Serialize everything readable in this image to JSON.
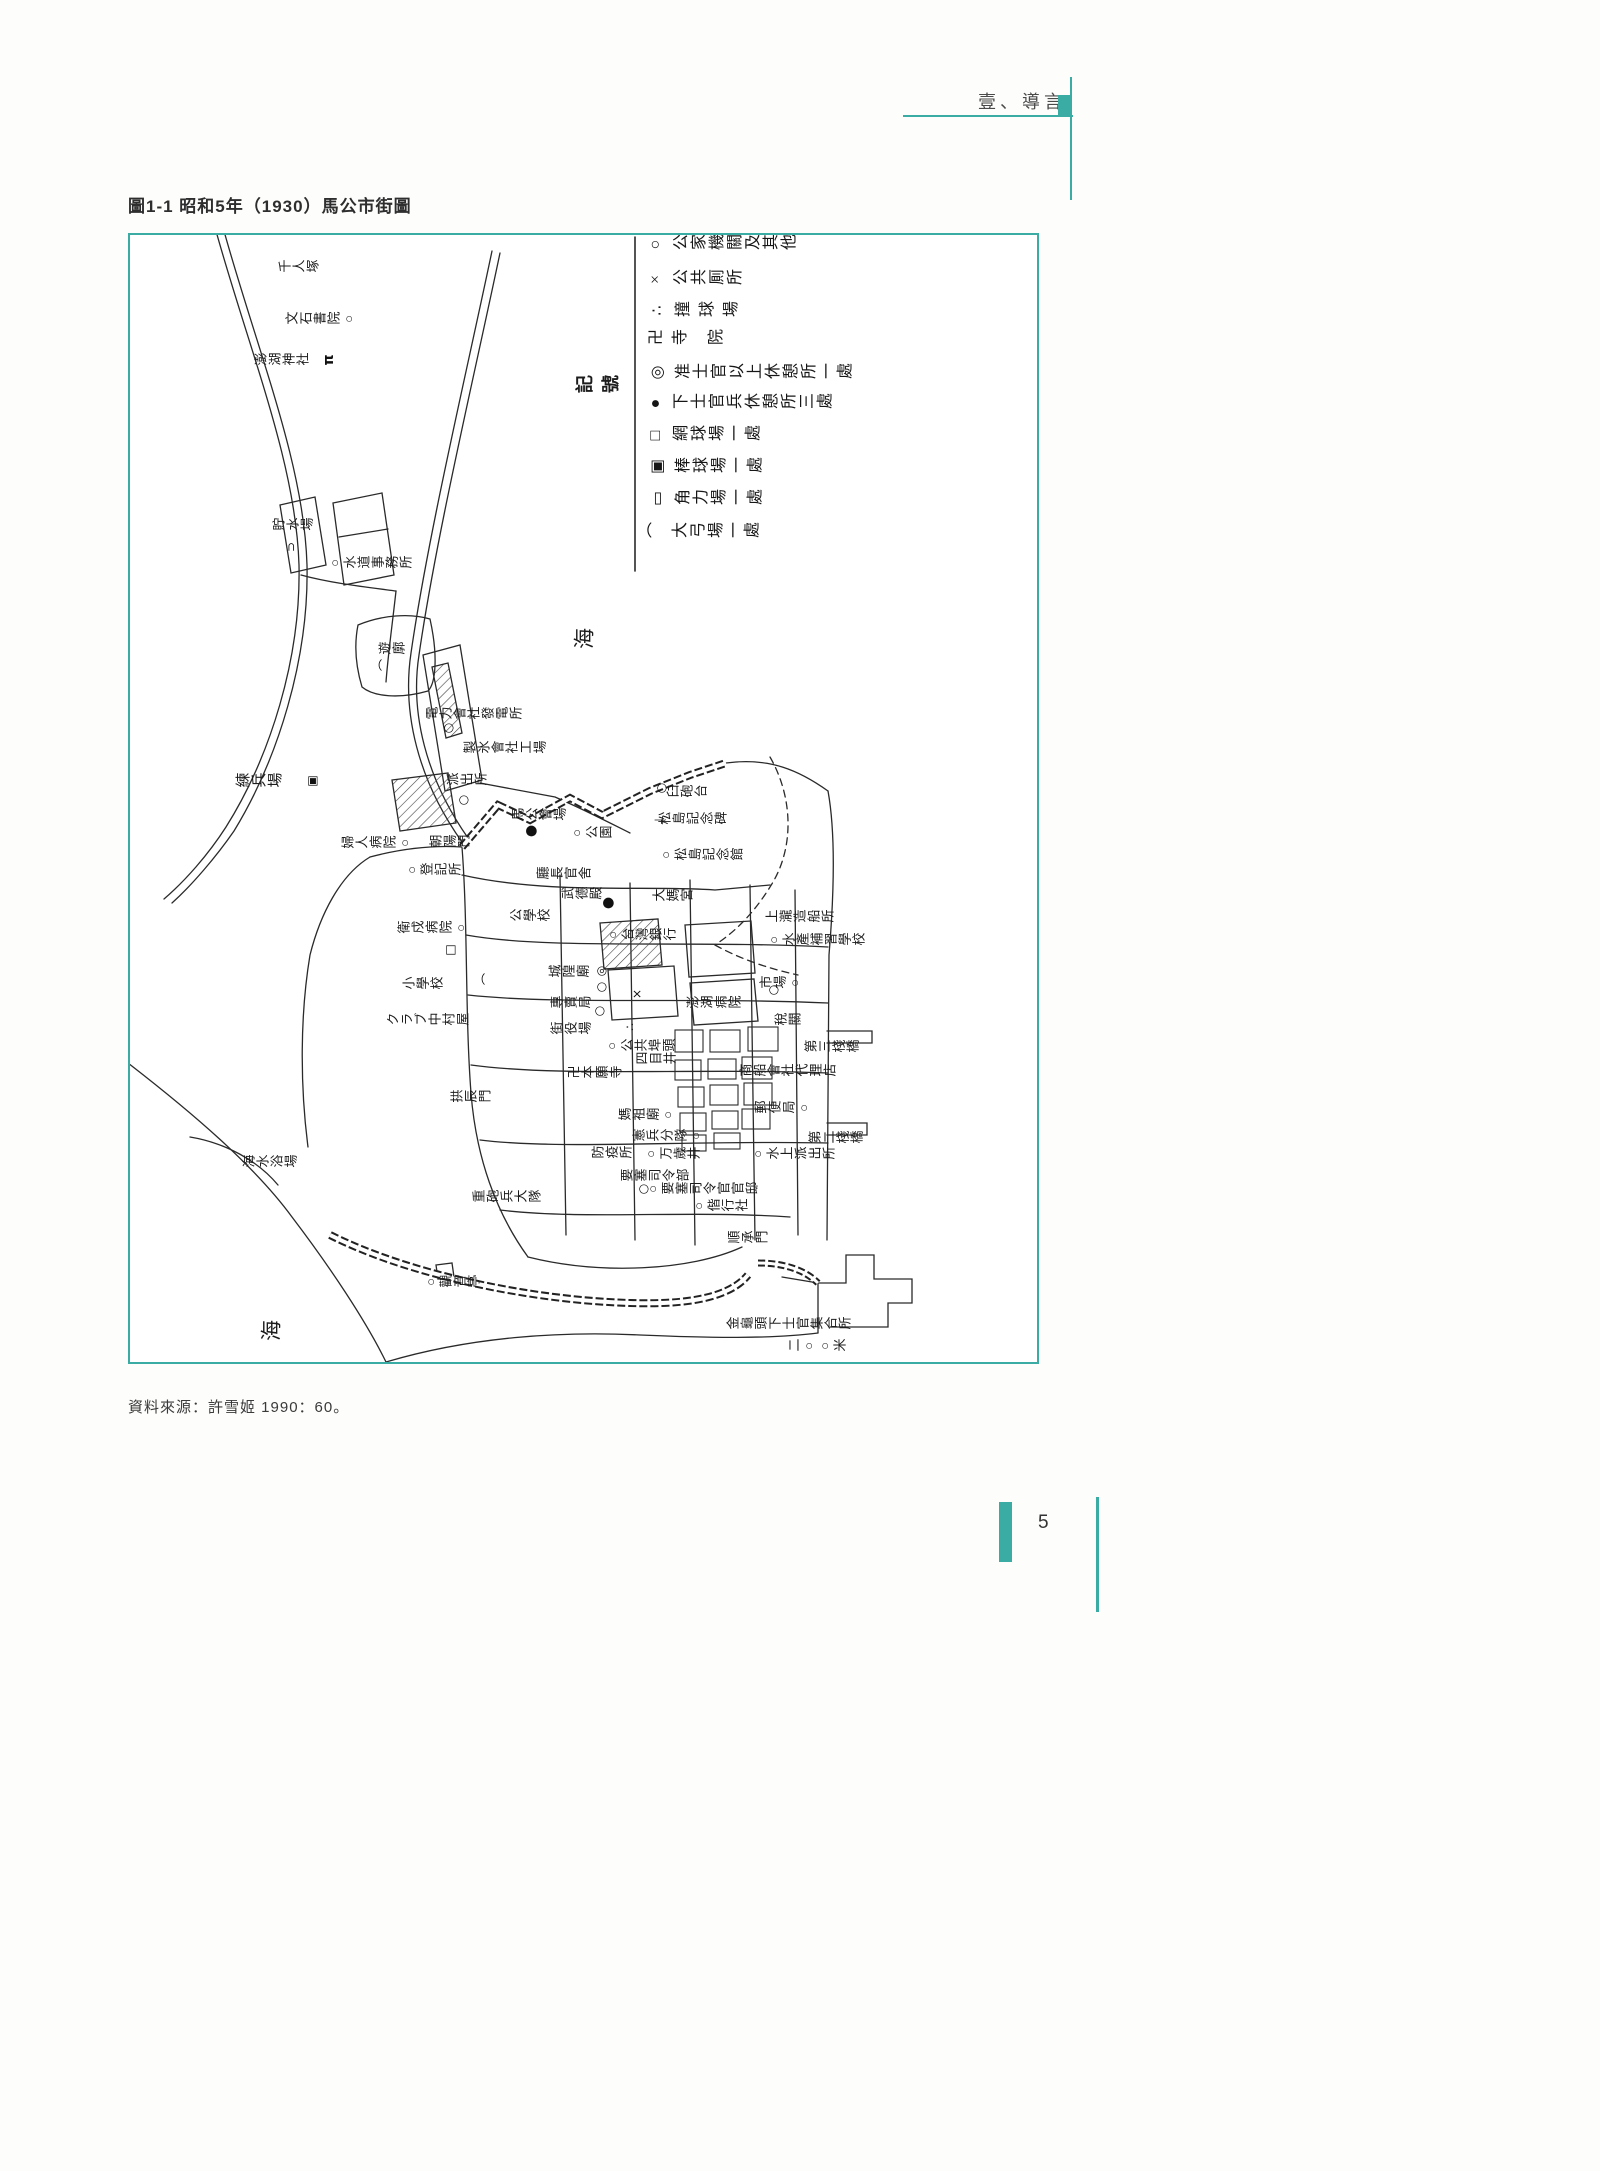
{
  "accent_color": "#3aaca4",
  "header": {
    "section_title": "壹、導言"
  },
  "figure": {
    "caption": "圖1-1  昭和5年（1930）馬公市街圖",
    "source": "資料來源：許雪姬 1990：60。"
  },
  "footer": {
    "page_number": "5"
  },
  "legend": {
    "title": "記號",
    "entries": [
      {
        "sym": "○",
        "text": "公家機關及其他"
      },
      {
        "sym": "×",
        "text": "公共厠所"
      },
      {
        "sym": "∴",
        "text": "撞 球 場"
      },
      {
        "sym": "卍",
        "text": "寺　院"
      },
      {
        "sym": "◎",
        "text": "准士官以上休憩所一處"
      },
      {
        "sym": "●",
        "text": "下士官兵休憩所三處"
      },
      {
        "sym": "□",
        "text": "網球場一處"
      },
      {
        "sym": "▣",
        "text": "棒球場一處"
      },
      {
        "sym": "▭",
        "text": "角力場一處"
      },
      {
        "sym": "⌒",
        "text": "大弓場一處"
      }
    ],
    "rows_y": [
      8,
      43,
      75,
      103,
      137,
      167,
      199,
      231,
      263,
      296
    ],
    "left_x": 517,
    "title_pos": {
      "x": 471,
      "y": 150
    }
  },
  "map": {
    "sea_label": "海",
    "labels": [
      {
        "t": "千人塚",
        "x": 169,
        "y": 32
      },
      {
        "t": "文石書院○",
        "x": 191,
        "y": 84
      },
      {
        "t": "澎湖神社",
        "x": 152,
        "y": 125
      },
      {
        "t": "貯水場",
        "x": 163,
        "y": 290
      },
      {
        "t": "○水道事務所",
        "x": 240,
        "y": 328
      },
      {
        "t": "遊廓",
        "x": 262,
        "y": 414
      },
      {
        "t": "海",
        "x": 455,
        "y": 405,
        "cls": "big"
      },
      {
        "t": "電力會社發電所",
        "x": 344,
        "y": 479
      },
      {
        "t": "製氷會社工場",
        "x": 375,
        "y": 513
      },
      {
        "t": "練兵場",
        "x": 129,
        "y": 547,
        "cls": "md"
      },
      {
        "t": "派出所",
        "x": 337,
        "y": 545
      },
      {
        "t": "馬公會場",
        "x": 409,
        "y": 580
      },
      {
        "t": "臼砲台",
        "x": 557,
        "y": 557
      },
      {
        "t": "松島記念碑",
        "x": 563,
        "y": 584
      },
      {
        "t": "○公園",
        "x": 461,
        "y": 598
      },
      {
        "t": "婦人病院○",
        "x": 247,
        "y": 608
      },
      {
        "t": "朝陽門",
        "x": 320,
        "y": 607
      },
      {
        "t": "○松島記念館",
        "x": 571,
        "y": 620
      },
      {
        "t": "○登記所",
        "x": 303,
        "y": 635
      },
      {
        "t": "廳長官舍",
        "x": 434,
        "y": 639
      },
      {
        "t": "武德殿",
        "x": 452,
        "y": 659
      },
      {
        "t": "大媽宮",
        "x": 543,
        "y": 661
      },
      {
        "t": "上瀧造船所",
        "x": 670,
        "y": 682
      },
      {
        "t": "公學校",
        "x": 400,
        "y": 681
      },
      {
        "t": "衛戍病院○",
        "x": 303,
        "y": 693
      },
      {
        "t": "○台灣銀行",
        "x": 511,
        "y": 700
      },
      {
        "t": "○水產補習學校",
        "x": 686,
        "y": 705
      },
      {
        "t": "城隍廟",
        "x": 439,
        "y": 737
      },
      {
        "t": "小學校",
        "x": 293,
        "y": 749
      },
      {
        "t": "市場○",
        "x": 651,
        "y": 748
      },
      {
        "t": "專賣局",
        "x": 441,
        "y": 768
      },
      {
        "t": "澎湖病院",
        "x": 584,
        "y": 768
      },
      {
        "t": "クラブ中村屋",
        "x": 298,
        "y": 785
      },
      {
        "t": "街役場",
        "x": 441,
        "y": 794
      },
      {
        "t": "稅關",
        "x": 658,
        "y": 785
      },
      {
        "t": "○公共埠頭",
        "x": 510,
        "y": 811
      },
      {
        "t": "四目井",
        "x": 526,
        "y": 824
      },
      {
        "t": "第三棧橋",
        "x": 702,
        "y": 812
      },
      {
        "t": "卍本願寺",
        "x": 465,
        "y": 838
      },
      {
        "t": "商船會社代理店",
        "x": 658,
        "y": 836
      },
      {
        "t": "拱辰門",
        "x": 341,
        "y": 862
      },
      {
        "t": "郵便局○",
        "x": 653,
        "y": 873
      },
      {
        "t": "媽祖廟○",
        "x": 517,
        "y": 880
      },
      {
        "t": "憲兵分隊○",
        "x": 538,
        "y": 901
      },
      {
        "t": "第二棧橋",
        "x": 706,
        "y": 903
      },
      {
        "t": "防疫所",
        "x": 482,
        "y": 918
      },
      {
        "t": "○万歲井",
        "x": 542,
        "y": 919
      },
      {
        "t": "○水上派出所",
        "x": 663,
        "y": 919
      },
      {
        "t": "海水浴場",
        "x": 140,
        "y": 927
      },
      {
        "t": "要塞司令部",
        "x": 525,
        "y": 941
      },
      {
        "t": "○要塞司令官官邸",
        "x": 572,
        "y": 954
      },
      {
        "t": "重砲兵大隊",
        "x": 377,
        "y": 962
      },
      {
        "t": "○偕行社",
        "x": 590,
        "y": 971
      },
      {
        "t": "順承門",
        "x": 618,
        "y": 1003
      },
      {
        "t": "○觀音亭",
        "x": 322,
        "y": 1047
      },
      {
        "t": "金龜頭下士官集合所",
        "x": 659,
        "y": 1089
      },
      {
        "t": "二○○米",
        "x": 687,
        "y": 1111
      },
      {
        "t": "海",
        "x": 142,
        "y": 1097,
        "cls": "big"
      }
    ],
    "marks": [
      {
        "k": "torii",
        "x": 199,
        "y": 125
      },
      {
        "k": "cup",
        "x": 161,
        "y": 312
      },
      {
        "k": "arc",
        "x": 255,
        "y": 430
      },
      {
        "k": "circle",
        "x": 318,
        "y": 493
      },
      {
        "k": "sqdot",
        "x": 182,
        "y": 546
      },
      {
        "k": "circle",
        "x": 333,
        "y": 565
      },
      {
        "k": "circle",
        "x": 531,
        "y": 553
      },
      {
        "k": "monument",
        "x": 529,
        "y": 585
      },
      {
        "k": "dot",
        "x": 401,
        "y": 596
      },
      {
        "k": "dot",
        "x": 478,
        "y": 668
      },
      {
        "k": "sq",
        "x": 320,
        "y": 715
      },
      {
        "k": "dblcircle",
        "x": 471,
        "y": 736
      },
      {
        "k": "arc",
        "x": 358,
        "y": 744
      },
      {
        "k": "circle",
        "x": 471,
        "y": 752
      },
      {
        "k": "x",
        "x": 507,
        "y": 759
      },
      {
        "k": "circle",
        "x": 643,
        "y": 755
      },
      {
        "k": "circle",
        "x": 469,
        "y": 776
      },
      {
        "k": "dots3",
        "x": 500,
        "y": 792
      },
      {
        "k": "circle",
        "x": 513,
        "y": 954
      }
    ]
  }
}
